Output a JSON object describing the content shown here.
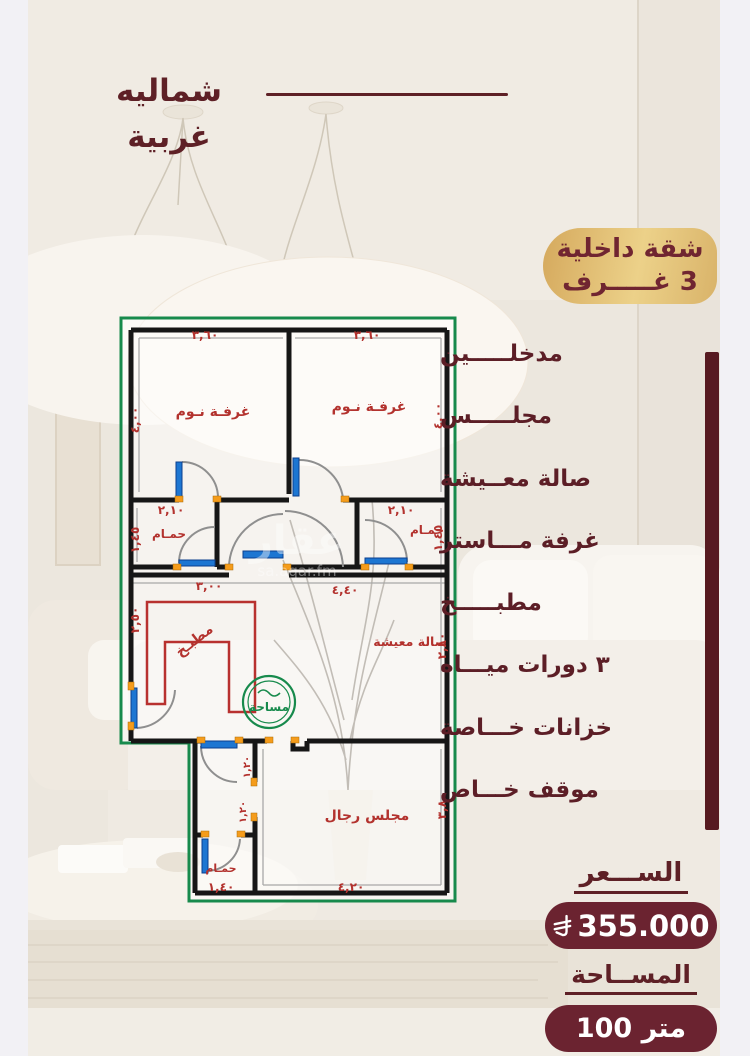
{
  "header": {
    "direction_label": "شماليه غربية"
  },
  "badge": {
    "line1": "شقة داخلية",
    "line2": "3 غـــــرف"
  },
  "features": {
    "items": [
      "مدخلـــــين",
      "مجلـــــس",
      "صالة معــيشة",
      "غرفة مـــاستر",
      "مطبـــــخ",
      "٣ دورات ميـــاه",
      "خزانات خـــاصة",
      "موقف خـــاص"
    ]
  },
  "pricing": {
    "price_label": "الســـعر",
    "price_value": "355.000",
    "area_label": "المســاحة",
    "area_value": "100 متر"
  },
  "plan": {
    "rooms": {
      "bedroom": "غرفـة نـوم",
      "bathroom": "حمـام",
      "kitchen": "مطبـخ",
      "living": "صالة معيشة",
      "majlis": "مجلس رجال"
    },
    "dims": {
      "bed_top": "٣,٦٠",
      "bed_side": "٤,٠٠",
      "bath_top": "٢,١٠",
      "bath_side": "١,٤٥",
      "kitchen_top": "٣,٠٠",
      "kitchen_side": "٢,٥٠",
      "living_top": "٤,٤٠",
      "living_side": "٢,٨٠",
      "majlis_side": "٣,٨٠",
      "majlis_bottom": "٤,٢٠",
      "small_bath": "١,٤٠",
      "corridor": "١,٢٠"
    },
    "stamp_text": "مساحة",
    "watermark": {
      "arabic": "عقار",
      "latin": "sa.aqar.fm"
    }
  },
  "colors": {
    "maroon": "#5e2026",
    "pill": "#6b2330",
    "gold": "#d9b369",
    "plan_green": "#178a4c",
    "plan_red": "#b3322e",
    "door_blue": "#1d76d2"
  }
}
